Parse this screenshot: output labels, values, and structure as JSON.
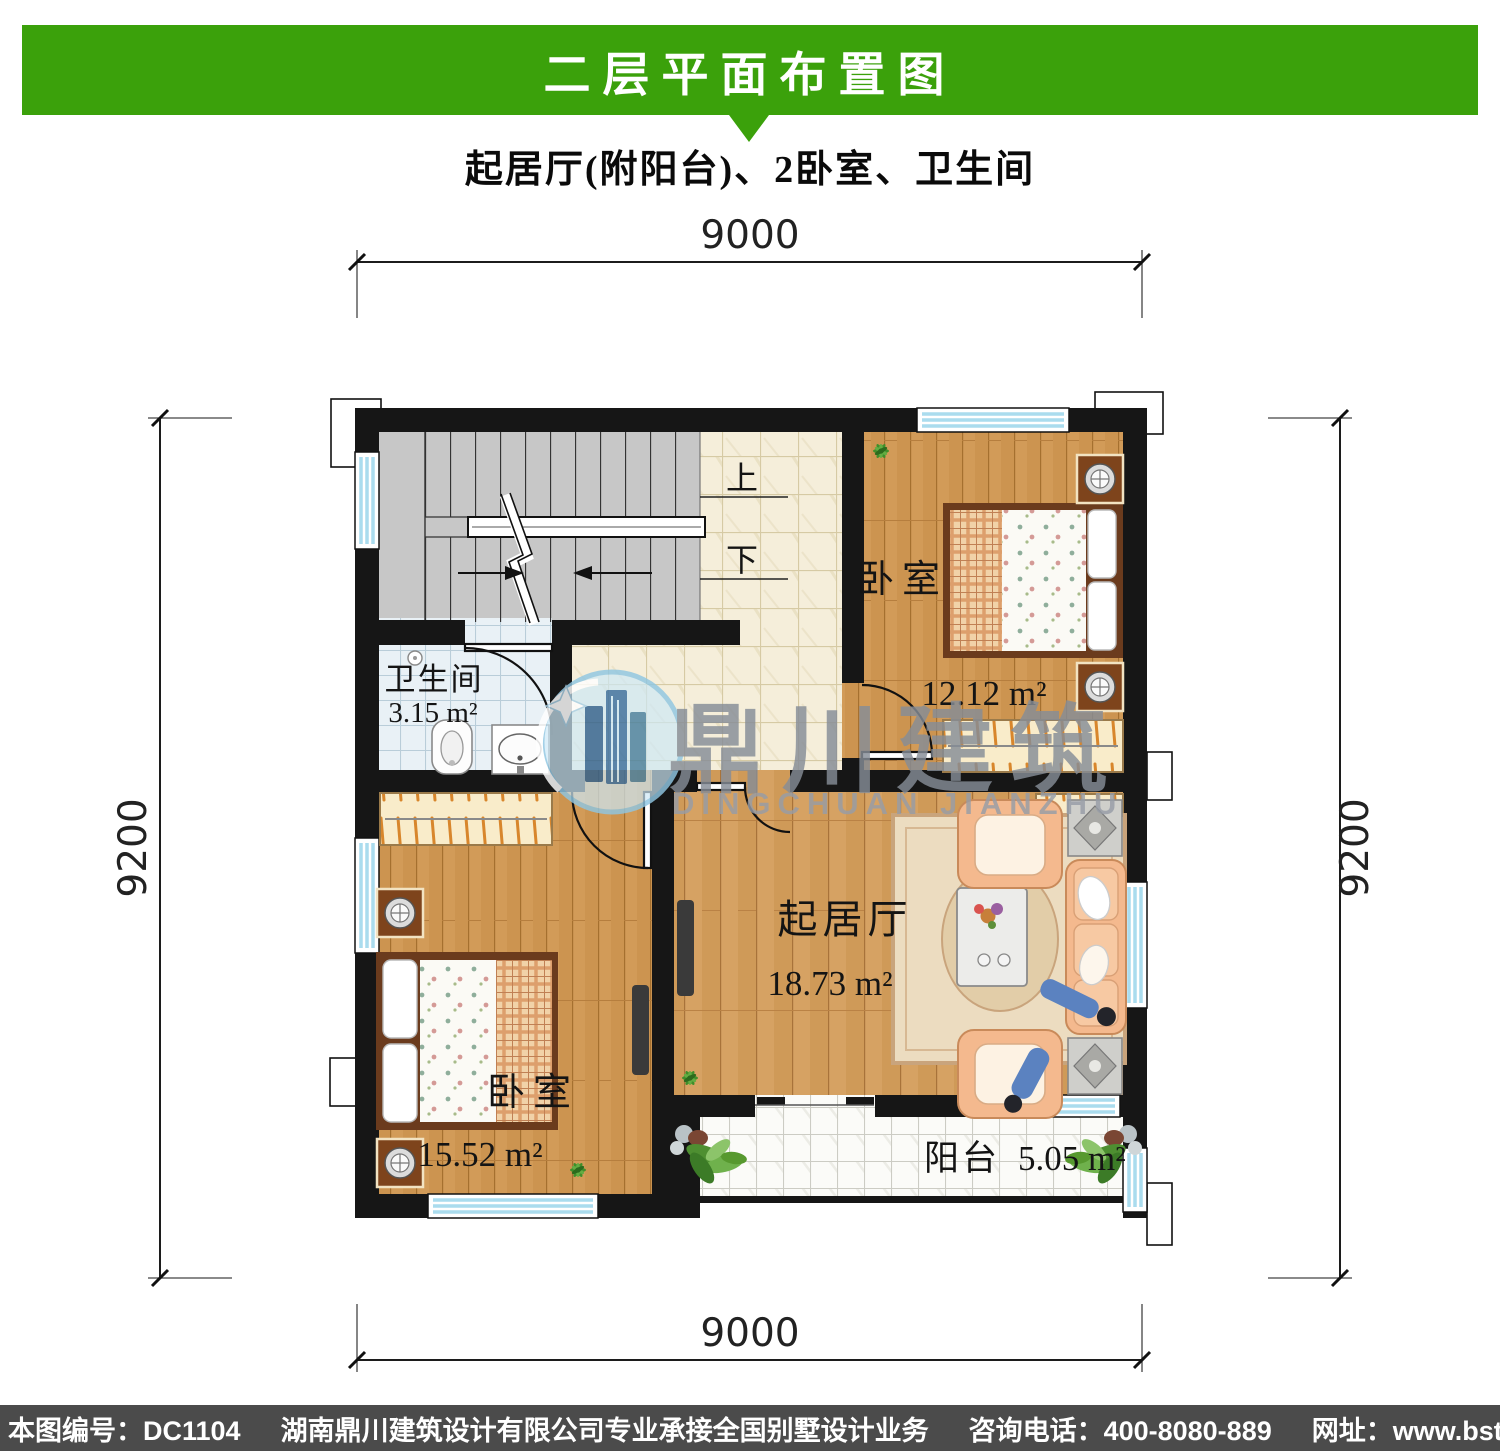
{
  "header": {
    "title": "二层平面布置图",
    "accent_color": "#3ba10b"
  },
  "subtitle": "起居厅(附阳台)、2卧室、卫生间",
  "dimensions": {
    "top": "9000",
    "bottom": "9000",
    "left": "9200",
    "right": "9200"
  },
  "stairs": {
    "up_label": "上",
    "down_label": "下"
  },
  "rooms": {
    "bathroom": {
      "name": "卫生间",
      "area": "3.15 m²"
    },
    "bedroom_top": {
      "name": "卧室",
      "area": "12.12 m²"
    },
    "bedroom_bottom": {
      "name": "卧室",
      "area": "15.52 m²"
    },
    "living": {
      "name": "起居厅",
      "area": "18.73 m²"
    },
    "balcony": {
      "name": "阳台",
      "area": "5.05 m²"
    }
  },
  "watermark": {
    "cn": "鼎川建筑",
    "en": "DINGCHUAN JIANZHU"
  },
  "footer": {
    "plan_no": "本图编号：DC1104",
    "company": "湖南鼎川建筑设计有限公司专业承接全国别墅设计业务",
    "phone": "咨询电话：400-8080-889",
    "website": "网址：www.bstzcs.com"
  }
}
